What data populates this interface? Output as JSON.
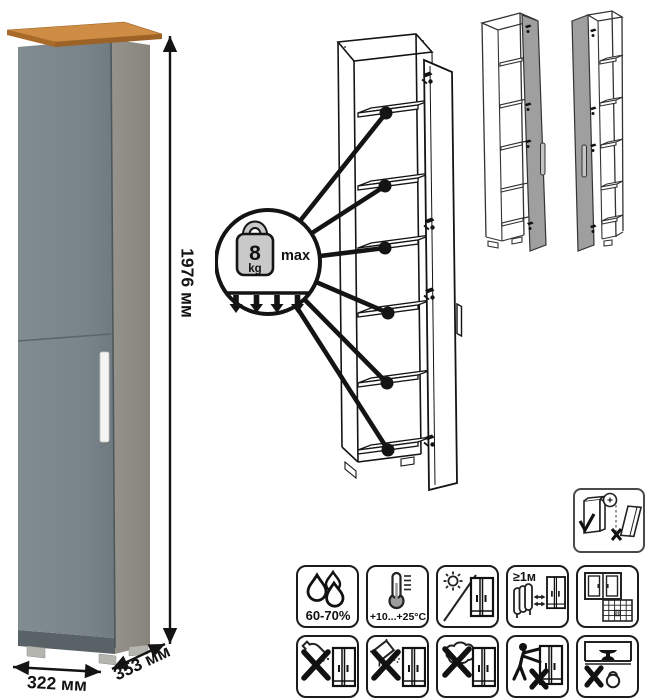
{
  "sheet": {
    "background": "#ffffff",
    "type": "furniture-product-care-sheet"
  },
  "product": {
    "dimensions": {
      "height": "1976 мм",
      "width": "322 мм",
      "depth": "353 мм"
    },
    "colors": {
      "front": "#79848a",
      "side": "#8d8b82",
      "top_edge": "#cf8c44",
      "handle": "#f4f4f2"
    }
  },
  "shelf_load_callout": {
    "value": "8",
    "unit": "kg",
    "qualifier": "max",
    "pointer_count": 6
  },
  "variants": {
    "count": 2,
    "descriptions": [
      "door-hinged-right-open",
      "door-hinged-left-open"
    ]
  },
  "care_instructions": {
    "wall_anchor_icon": "wall-anchor-warning-icon",
    "grid": [
      {
        "icon": "humidity-icon",
        "label": "60-70%"
      },
      {
        "icon": "temperature-icon",
        "label": "+10...+25°C"
      },
      {
        "icon": "no-direct-sunlight-icon",
        "label": ""
      },
      {
        "icon": "heat-distance-icon",
        "label": "≥1м"
      },
      {
        "icon": "ventilation-icon",
        "label": "",
        "calendar_day": "21"
      },
      {
        "icon": "no-liquids-icon",
        "label": ""
      },
      {
        "icon": "no-abrasive-powder-icon",
        "label": ""
      },
      {
        "icon": "no-wet-cleaning-icon",
        "label": ""
      },
      {
        "icon": "no-dragging-icon",
        "label": ""
      },
      {
        "icon": "no-heavy-items-icon",
        "label": ""
      }
    ]
  }
}
